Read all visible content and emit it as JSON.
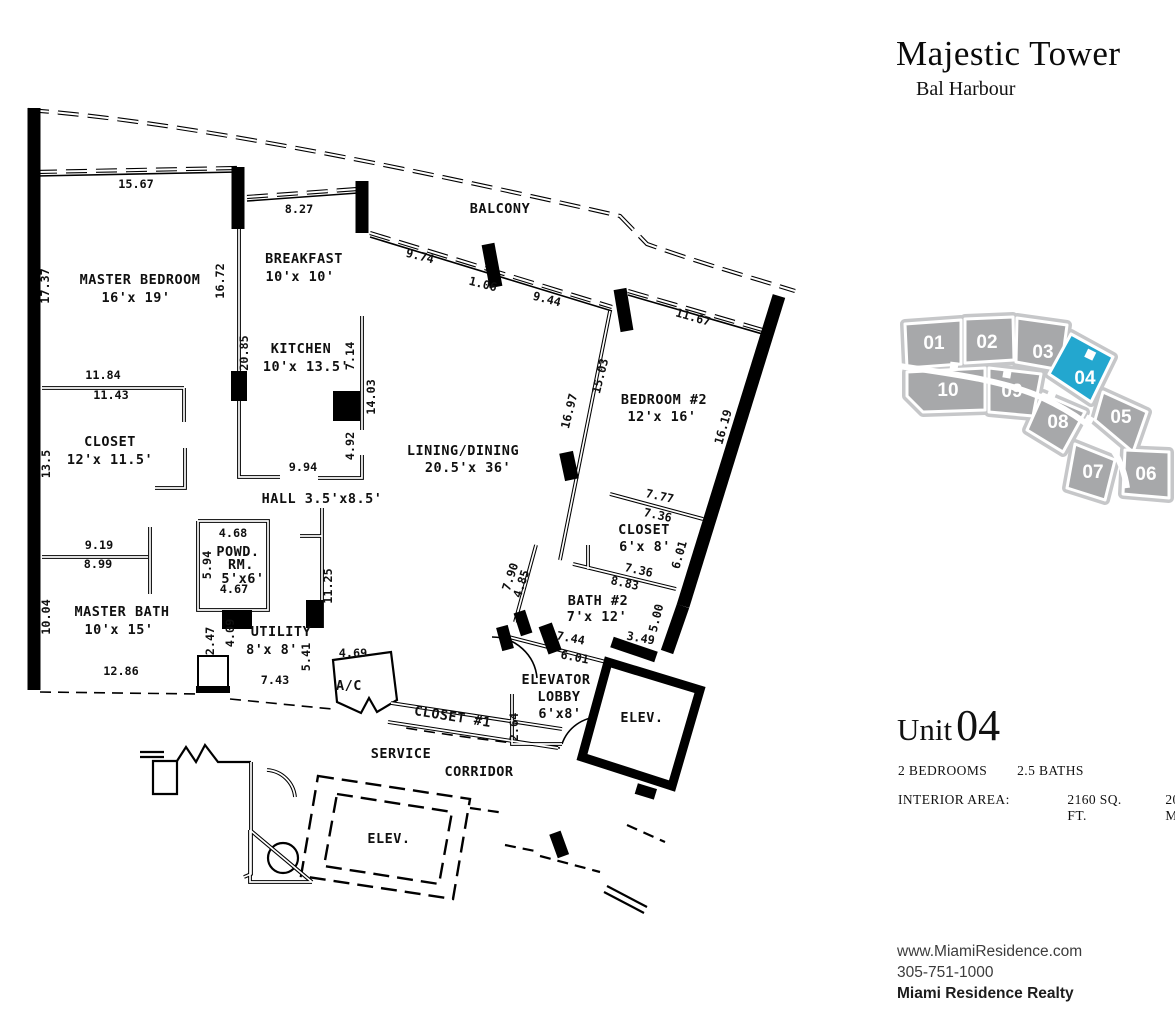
{
  "header": {
    "title": "Majestic Tower",
    "subtitle": "Bal Harbour"
  },
  "keyplan": {
    "highlighted_unit": "04",
    "highlight_color": "#23a7cf",
    "unit_color": "#a7a8aa",
    "units": [
      {
        "label": "01",
        "x": 41,
        "y": 49
      },
      {
        "label": "02",
        "x": 94,
        "y": 48
      },
      {
        "label": "03",
        "x": 150,
        "y": 58
      },
      {
        "label": "04",
        "x": 192,
        "y": 84
      },
      {
        "label": "05",
        "x": 228,
        "y": 123
      },
      {
        "label": "06",
        "x": 253,
        "y": 180
      },
      {
        "label": "07",
        "x": 200,
        "y": 178
      },
      {
        "label": "08",
        "x": 165,
        "y": 128
      },
      {
        "label": "09",
        "x": 119,
        "y": 97
      },
      {
        "label": "10",
        "x": 55,
        "y": 96
      }
    ]
  },
  "unit_info": {
    "prefix": "Unit",
    "number": "04",
    "beds": "2 BEDROOMS",
    "baths": "2.5 BATHS",
    "area_label": "INTERIOR AREA:",
    "area_sqft": "2160 SQ. FT.",
    "area_sqm": "200.7 M²"
  },
  "footer": {
    "website": "www.MiamiResidence.com",
    "phone": "305-751-1000",
    "company": "Miami Residence Realty"
  },
  "floorplan": {
    "rooms": [
      {
        "text": "MASTER BEDROOM",
        "x": 140,
        "y": 284
      },
      {
        "text": "16'x 19'",
        "x": 136,
        "y": 302
      },
      {
        "text": "BREAKFAST",
        "x": 304,
        "y": 263
      },
      {
        "text": "10'x 10'",
        "x": 300,
        "y": 281
      },
      {
        "text": "KITCHEN",
        "x": 301,
        "y": 353
      },
      {
        "text": "10'x 13.5'",
        "x": 306,
        "y": 371
      },
      {
        "text": "BALCONY",
        "x": 500,
        "y": 213
      },
      {
        "text": "CLOSET",
        "x": 110,
        "y": 446
      },
      {
        "text": "12'x 11.5'",
        "x": 110,
        "y": 464
      },
      {
        "text": "HALL 3.5'x8.5'",
        "x": 322,
        "y": 503
      },
      {
        "text": "LINING/DINING",
        "x": 463,
        "y": 455
      },
      {
        "text": "20.5'x 36'",
        "x": 468,
        "y": 472
      },
      {
        "text": "BEDROOM #2",
        "x": 664,
        "y": 404
      },
      {
        "text": "12'x 16'",
        "x": 662,
        "y": 421
      },
      {
        "text": "POWD.",
        "x": 238,
        "y": 556,
        "s": 12
      },
      {
        "text": "RM.",
        "x": 241,
        "y": 569,
        "s": 12
      },
      {
        "text": "5'x6'",
        "x": 243,
        "y": 583,
        "s": 12
      },
      {
        "text": "MASTER BATH",
        "x": 122,
        "y": 616
      },
      {
        "text": "10'x 15'",
        "x": 119,
        "y": 634
      },
      {
        "text": "UTILITY",
        "x": 281,
        "y": 636
      },
      {
        "text": "8'x 8'",
        "x": 272,
        "y": 654
      },
      {
        "text": "A/C",
        "x": 349,
        "y": 690,
        "s": 12
      },
      {
        "text": "CLOSET #1",
        "x": 452,
        "y": 721,
        "rot": 9
      },
      {
        "text": "ELEVATOR",
        "x": 556,
        "y": 684
      },
      {
        "text": "LOBBY",
        "x": 559,
        "y": 701
      },
      {
        "text": "6'x8'",
        "x": 560,
        "y": 718
      },
      {
        "text": "BATH #2",
        "x": 598,
        "y": 605
      },
      {
        "text": "7'x 12'",
        "x": 597,
        "y": 621
      },
      {
        "text": "CLOSET",
        "x": 644,
        "y": 534
      },
      {
        "text": "6'x 8'",
        "x": 645,
        "y": 551
      },
      {
        "text": "SERVICE",
        "x": 401,
        "y": 758
      },
      {
        "text": "CORRIDOR",
        "x": 479,
        "y": 776
      },
      {
        "text": "ELEV.",
        "x": 642,
        "y": 722
      },
      {
        "text": "ELEV.",
        "x": 389,
        "y": 843
      }
    ],
    "dims": [
      {
        "text": "15.67",
        "x": 136,
        "y": 188
      },
      {
        "text": "8.27",
        "x": 299,
        "y": 213
      },
      {
        "text": "9.74",
        "x": 419,
        "y": 260,
        "rot": 14
      },
      {
        "text": "1.06",
        "x": 482,
        "y": 288,
        "rot": 14
      },
      {
        "text": "9.44",
        "x": 546,
        "y": 303,
        "rot": 14
      },
      {
        "text": "11.67",
        "x": 692,
        "y": 321,
        "rot": 16
      },
      {
        "text": "17.37",
        "x": 49,
        "y": 286,
        "rot": -90
      },
      {
        "text": "16.72",
        "x": 224,
        "y": 281,
        "rot": -90
      },
      {
        "text": "20.85",
        "x": 248,
        "y": 353,
        "rot": -90
      },
      {
        "text": "7.14",
        "x": 354,
        "y": 356,
        "rot": -90
      },
      {
        "text": "14.03",
        "x": 375,
        "y": 397,
        "rot": -90
      },
      {
        "text": "4.92",
        "x": 354,
        "y": 446,
        "rot": -90
      },
      {
        "text": "9.94",
        "x": 303,
        "y": 471
      },
      {
        "text": "11.84",
        "x": 103,
        "y": 379
      },
      {
        "text": "11.43",
        "x": 111,
        "y": 399
      },
      {
        "text": "13.5",
        "x": 50,
        "y": 464,
        "rot": -90
      },
      {
        "text": "9.19",
        "x": 99,
        "y": 549
      },
      {
        "text": "8.99",
        "x": 98,
        "y": 568
      },
      {
        "text": "10.04",
        "x": 50,
        "y": 617,
        "rot": -90
      },
      {
        "text": "12.86",
        "x": 121,
        "y": 675
      },
      {
        "text": "15.03",
        "x": 604,
        "y": 377,
        "rot": -76
      },
      {
        "text": "16.97",
        "x": 573,
        "y": 412,
        "rot": -76
      },
      {
        "text": "16.19",
        "x": 727,
        "y": 428,
        "rot": -74
      },
      {
        "text": "4.68",
        "x": 233,
        "y": 537
      },
      {
        "text": "5.94",
        "x": 211,
        "y": 565,
        "rot": -90
      },
      {
        "text": "4.67",
        "x": 234,
        "y": 593
      },
      {
        "text": "2.47",
        "x": 214,
        "y": 641,
        "rot": -90
      },
      {
        "text": "4.09",
        "x": 234,
        "y": 633,
        "rot": -90
      },
      {
        "text": "5.41",
        "x": 310,
        "y": 657,
        "rot": -90
      },
      {
        "text": "4.69",
        "x": 353,
        "y": 657
      },
      {
        "text": "7.43",
        "x": 275,
        "y": 684
      },
      {
        "text": "11.25",
        "x": 332,
        "y": 586,
        "rot": -90
      },
      {
        "text": "7.90",
        "x": 514,
        "y": 578,
        "rot": -72
      },
      {
        "text": "4.85",
        "x": 525,
        "y": 585,
        "rot": -72
      },
      {
        "text": "7.77",
        "x": 659,
        "y": 500,
        "rot": 12
      },
      {
        "text": "7.36",
        "x": 657,
        "y": 519,
        "rot": 12
      },
      {
        "text": "6.01",
        "x": 683,
        "y": 556,
        "rot": -74
      },
      {
        "text": "7.36",
        "x": 638,
        "y": 574,
        "rot": 12
      },
      {
        "text": "8.83",
        "x": 624,
        "y": 587,
        "rot": 12
      },
      {
        "text": "5.00",
        "x": 660,
        "y": 619,
        "rot": -76
      },
      {
        "text": "3.49",
        "x": 640,
        "y": 642,
        "rot": 10
      },
      {
        "text": "7.44",
        "x": 570,
        "y": 642,
        "rot": 11
      },
      {
        "text": "6.01",
        "x": 574,
        "y": 661,
        "rot": 11
      },
      {
        "text": "2.64",
        "x": 518,
        "y": 727,
        "rot": -90
      }
    ]
  }
}
